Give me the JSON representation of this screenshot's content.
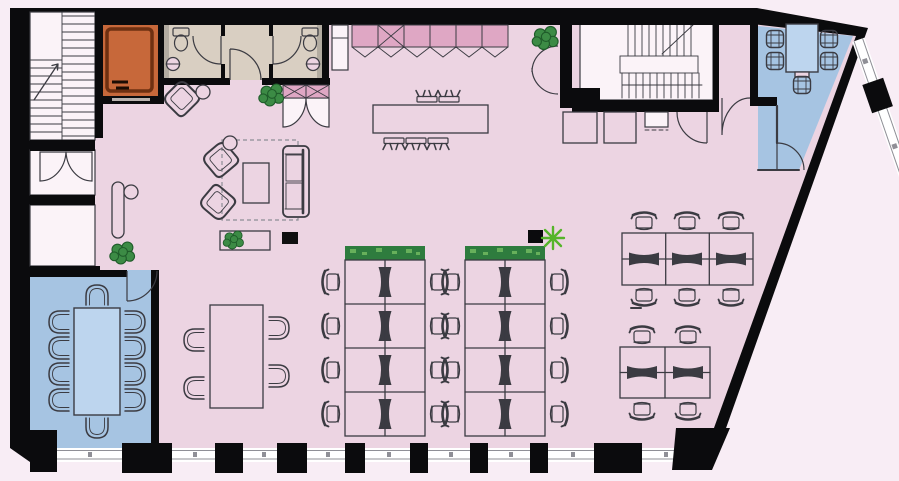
{
  "title": "Office floor plan",
  "colors": {
    "exterior": "#f8edf5",
    "wall": "#0b0b0d",
    "floor": "#ecd4e2",
    "line": "#3b3b42",
    "meeting": "#a6c4e2",
    "meeting_table": "#bdd5ee",
    "wc": "#d9cfc2",
    "wc_shade": "#b3aca1",
    "elevator": "#c7683a",
    "elevator_line": "#6e3011",
    "cabinet": "#dfa7c4",
    "stair": "#fbf3f8",
    "window": "#ffffff",
    "window_frame": "#8f8f96",
    "plant": "#3c8b45",
    "plant_dark": "#1f5c2a",
    "planter": "#2e7c3e",
    "planter_speckle": "#67b05b",
    "star": "#55b42a",
    "rug": "#8d8d95",
    "tv": "#101010"
  },
  "rooms": [
    {
      "id": "main-office",
      "fill": "floor"
    },
    {
      "id": "meeting-room-bottom-left",
      "fill": "meeting"
    },
    {
      "id": "meeting-room-top-right",
      "fill": "meeting"
    },
    {
      "id": "wc-left",
      "fill": "wc"
    },
    {
      "id": "wc-right",
      "fill": "wc"
    },
    {
      "id": "elevator-room",
      "fill": "elevator"
    },
    {
      "id": "stairwell-top-left",
      "fill": "stair"
    },
    {
      "id": "stairwell-top-right",
      "fill": "stair"
    }
  ],
  "inventory": {
    "bench_desks": 16,
    "cluster_desks_mid_right": 6,
    "cluster_desks_bottom_right": 4,
    "task_chairs": 26,
    "conference_seats_bottom_left": 10,
    "meeting_seats_top_right": 5,
    "small_table_seats": 4,
    "island_stools": 5,
    "lounge_armchairs": 2,
    "entrance_armchairs": 1,
    "sofas": 1,
    "wall_benches": 1,
    "coffee_tables": 1,
    "sideboards": 1,
    "tv_screens": 1,
    "potted_plants": 4,
    "desk_planters": 2,
    "star_plants": 1,
    "toilets": 2,
    "sinks": 2,
    "storage_boxes": 3
  }
}
